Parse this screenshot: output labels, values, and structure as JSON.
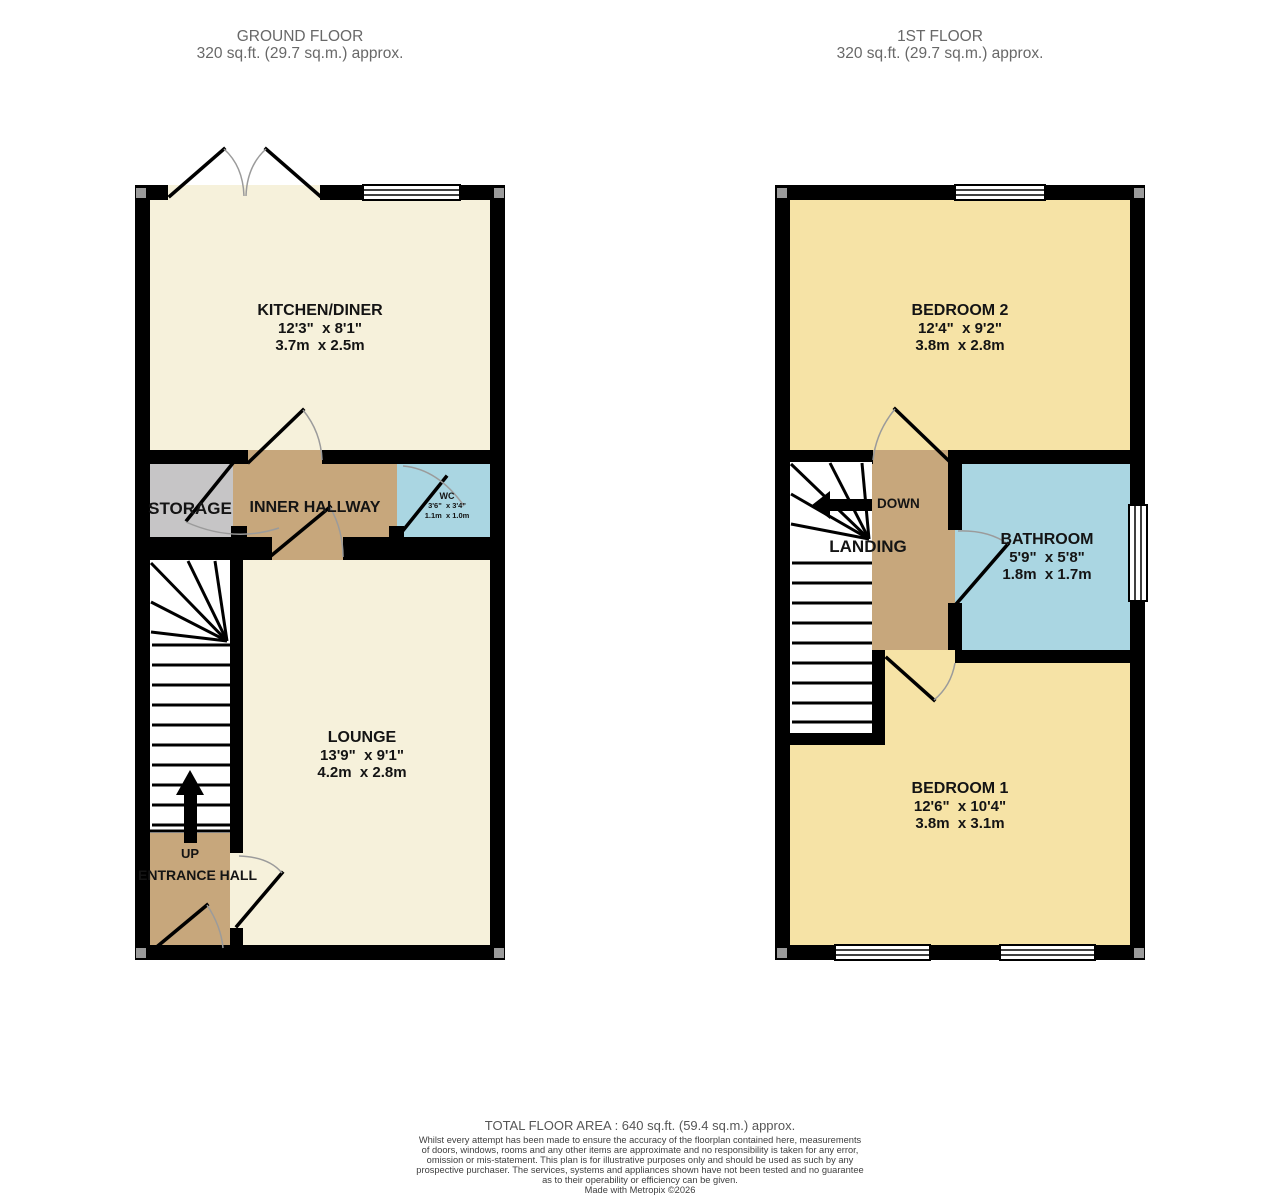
{
  "palette": {
    "wall": "#000000",
    "floor_cream": "#F6F1DB",
    "floor_yellow": "#F6E3A6",
    "floor_tan": "#C7A77C",
    "floor_gray": "#C6C5C6",
    "floor_blue": "#AAD6E2",
    "stairs_white": "#FFFFFF",
    "door_arc": "#9B9B9B",
    "title_text": "#686868",
    "label_text": "#141414",
    "footer_text": "#3E3E3E"
  },
  "ground_floor": {
    "title": "GROUND FLOOR",
    "area": "320 sq.ft. (29.7 sq.m.) approx.",
    "stairs_label": "UP",
    "rooms": {
      "kitchen_diner": {
        "name": "KITCHEN/DINER",
        "imperial": "12'3\"  x 8'1\"",
        "metric": "3.7m  x 2.5m"
      },
      "storage": {
        "name": "STORAGE"
      },
      "inner_hallway": {
        "name": "INNER HALLWAY"
      },
      "wc": {
        "name": "WC",
        "imperial": "3'6\"  x 3'4\"",
        "metric": "1.1m  x 1.0m"
      },
      "lounge": {
        "name": "LOUNGE",
        "imperial": "13'9\"  x 9'1\"",
        "metric": "4.2m  x 2.8m"
      },
      "entrance_hall": {
        "name": "ENTRANCE HALL"
      }
    }
  },
  "first_floor": {
    "title": "1ST FLOOR",
    "area": "320 sq.ft. (29.7 sq.m.) approx.",
    "stairs_label": "DOWN",
    "rooms": {
      "bedroom_2": {
        "name": "BEDROOM 2",
        "imperial": "12'4\"  x 9'2\"",
        "metric": "3.8m  x 2.8m"
      },
      "landing": {
        "name": "LANDING"
      },
      "bathroom": {
        "name": "BATHROOM",
        "imperial": "5'9\"  x 5'8\"",
        "metric": "1.8m  x 1.7m"
      },
      "bedroom_1": {
        "name": "BEDROOM 1",
        "imperial": "12'6\"  x 10'4\"",
        "metric": "3.8m  x 3.1m"
      }
    }
  },
  "footer": {
    "total_area": "TOTAL FLOOR AREA : 640 sq.ft. (59.4 sq.m.) approx.",
    "disclaimer_lines": [
      "Whilst every attempt has been made to ensure the accuracy of the floorplan contained here, measurements",
      "of doors, windows, rooms and any other items are approximate and no responsibility is taken for any error,",
      "omission or mis-statement. This plan is for illustrative purposes only and should be used as such by any",
      "prospective purchaser. The services, systems and appliances shown have not been tested and no guarantee",
      "as to their operability or efficiency can be given."
    ],
    "credit": "Made with Metropix ©2026"
  }
}
